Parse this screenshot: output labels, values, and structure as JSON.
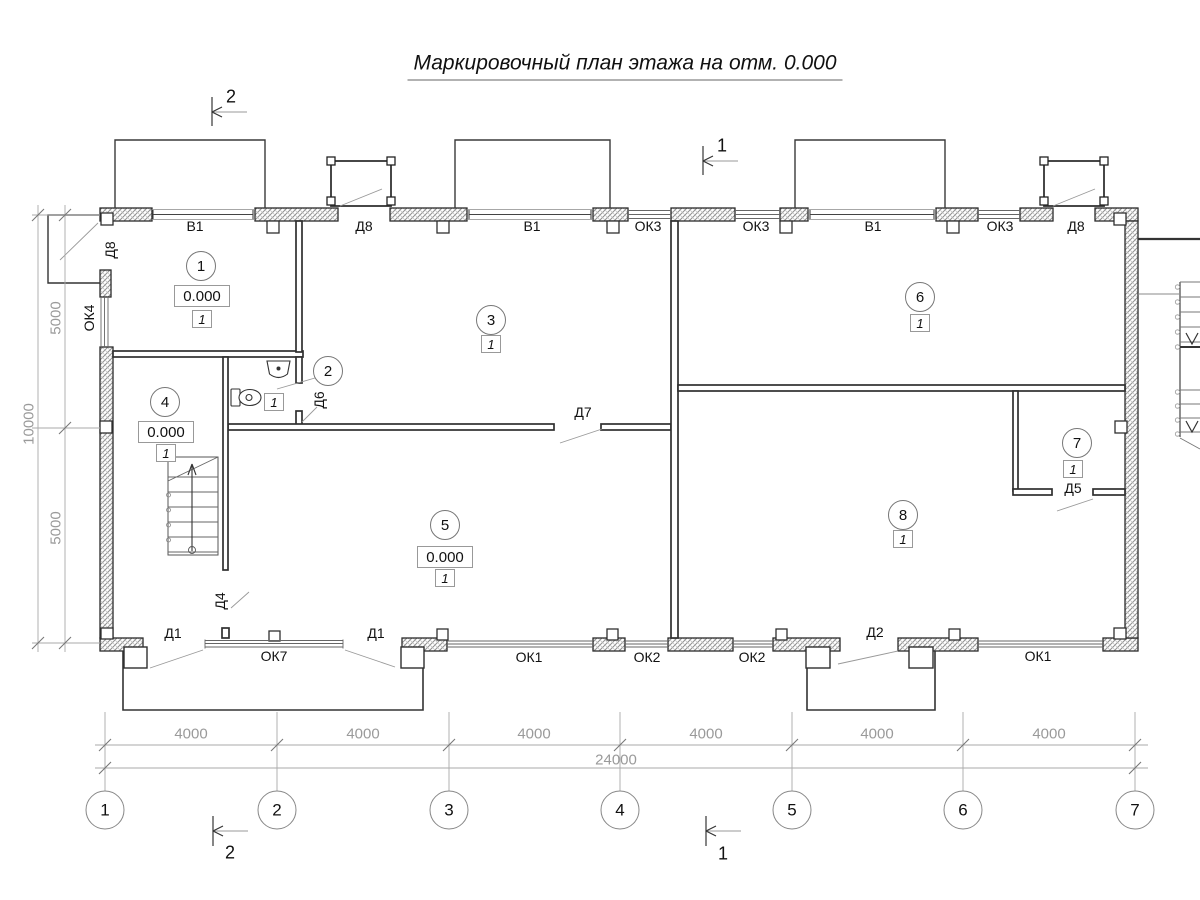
{
  "title": "Маркировочный план этажа на отм. 0.000",
  "axes": [
    "1",
    "2",
    "3",
    "4",
    "5",
    "6",
    "7"
  ],
  "dims": {
    "bottom": [
      "4000",
      "4000",
      "4000",
      "4000",
      "4000",
      "4000"
    ],
    "bottom_total": "24000",
    "left": [
      "5000",
      "5000"
    ],
    "left_total": "10000"
  },
  "sections": {
    "tl": "2",
    "tr": "1",
    "bl": "2",
    "br": "1"
  },
  "rooms": {
    "r1": {
      "num": "1",
      "elev": "0.000",
      "fin": "1"
    },
    "r2": {
      "num": "2",
      "fin": "1"
    },
    "r3": {
      "num": "3",
      "fin": "1"
    },
    "r4": {
      "num": "4",
      "elev": "0.000",
      "fin": "1"
    },
    "r5": {
      "num": "5",
      "elev": "0.000",
      "fin": "1"
    },
    "r6": {
      "num": "6",
      "fin": "1"
    },
    "r7": {
      "num": "7",
      "fin": "1"
    },
    "r8": {
      "num": "8",
      "fin": "1"
    }
  },
  "openings": {
    "top": [
      "В1",
      "Д8",
      "В1",
      "ОК3",
      "ОК3",
      "В1",
      "ОК3",
      "Д8"
    ],
    "bottom": [
      "Д1",
      "ОК7",
      "Д1",
      "ОК1",
      "ОК2",
      "ОК2",
      "Д2",
      "ОК1"
    ],
    "left_d8": "Д8",
    "ok4": "ОК4",
    "d4": "Д4",
    "d5": "Д5",
    "d6": "Д6",
    "d7": "Д7"
  }
}
